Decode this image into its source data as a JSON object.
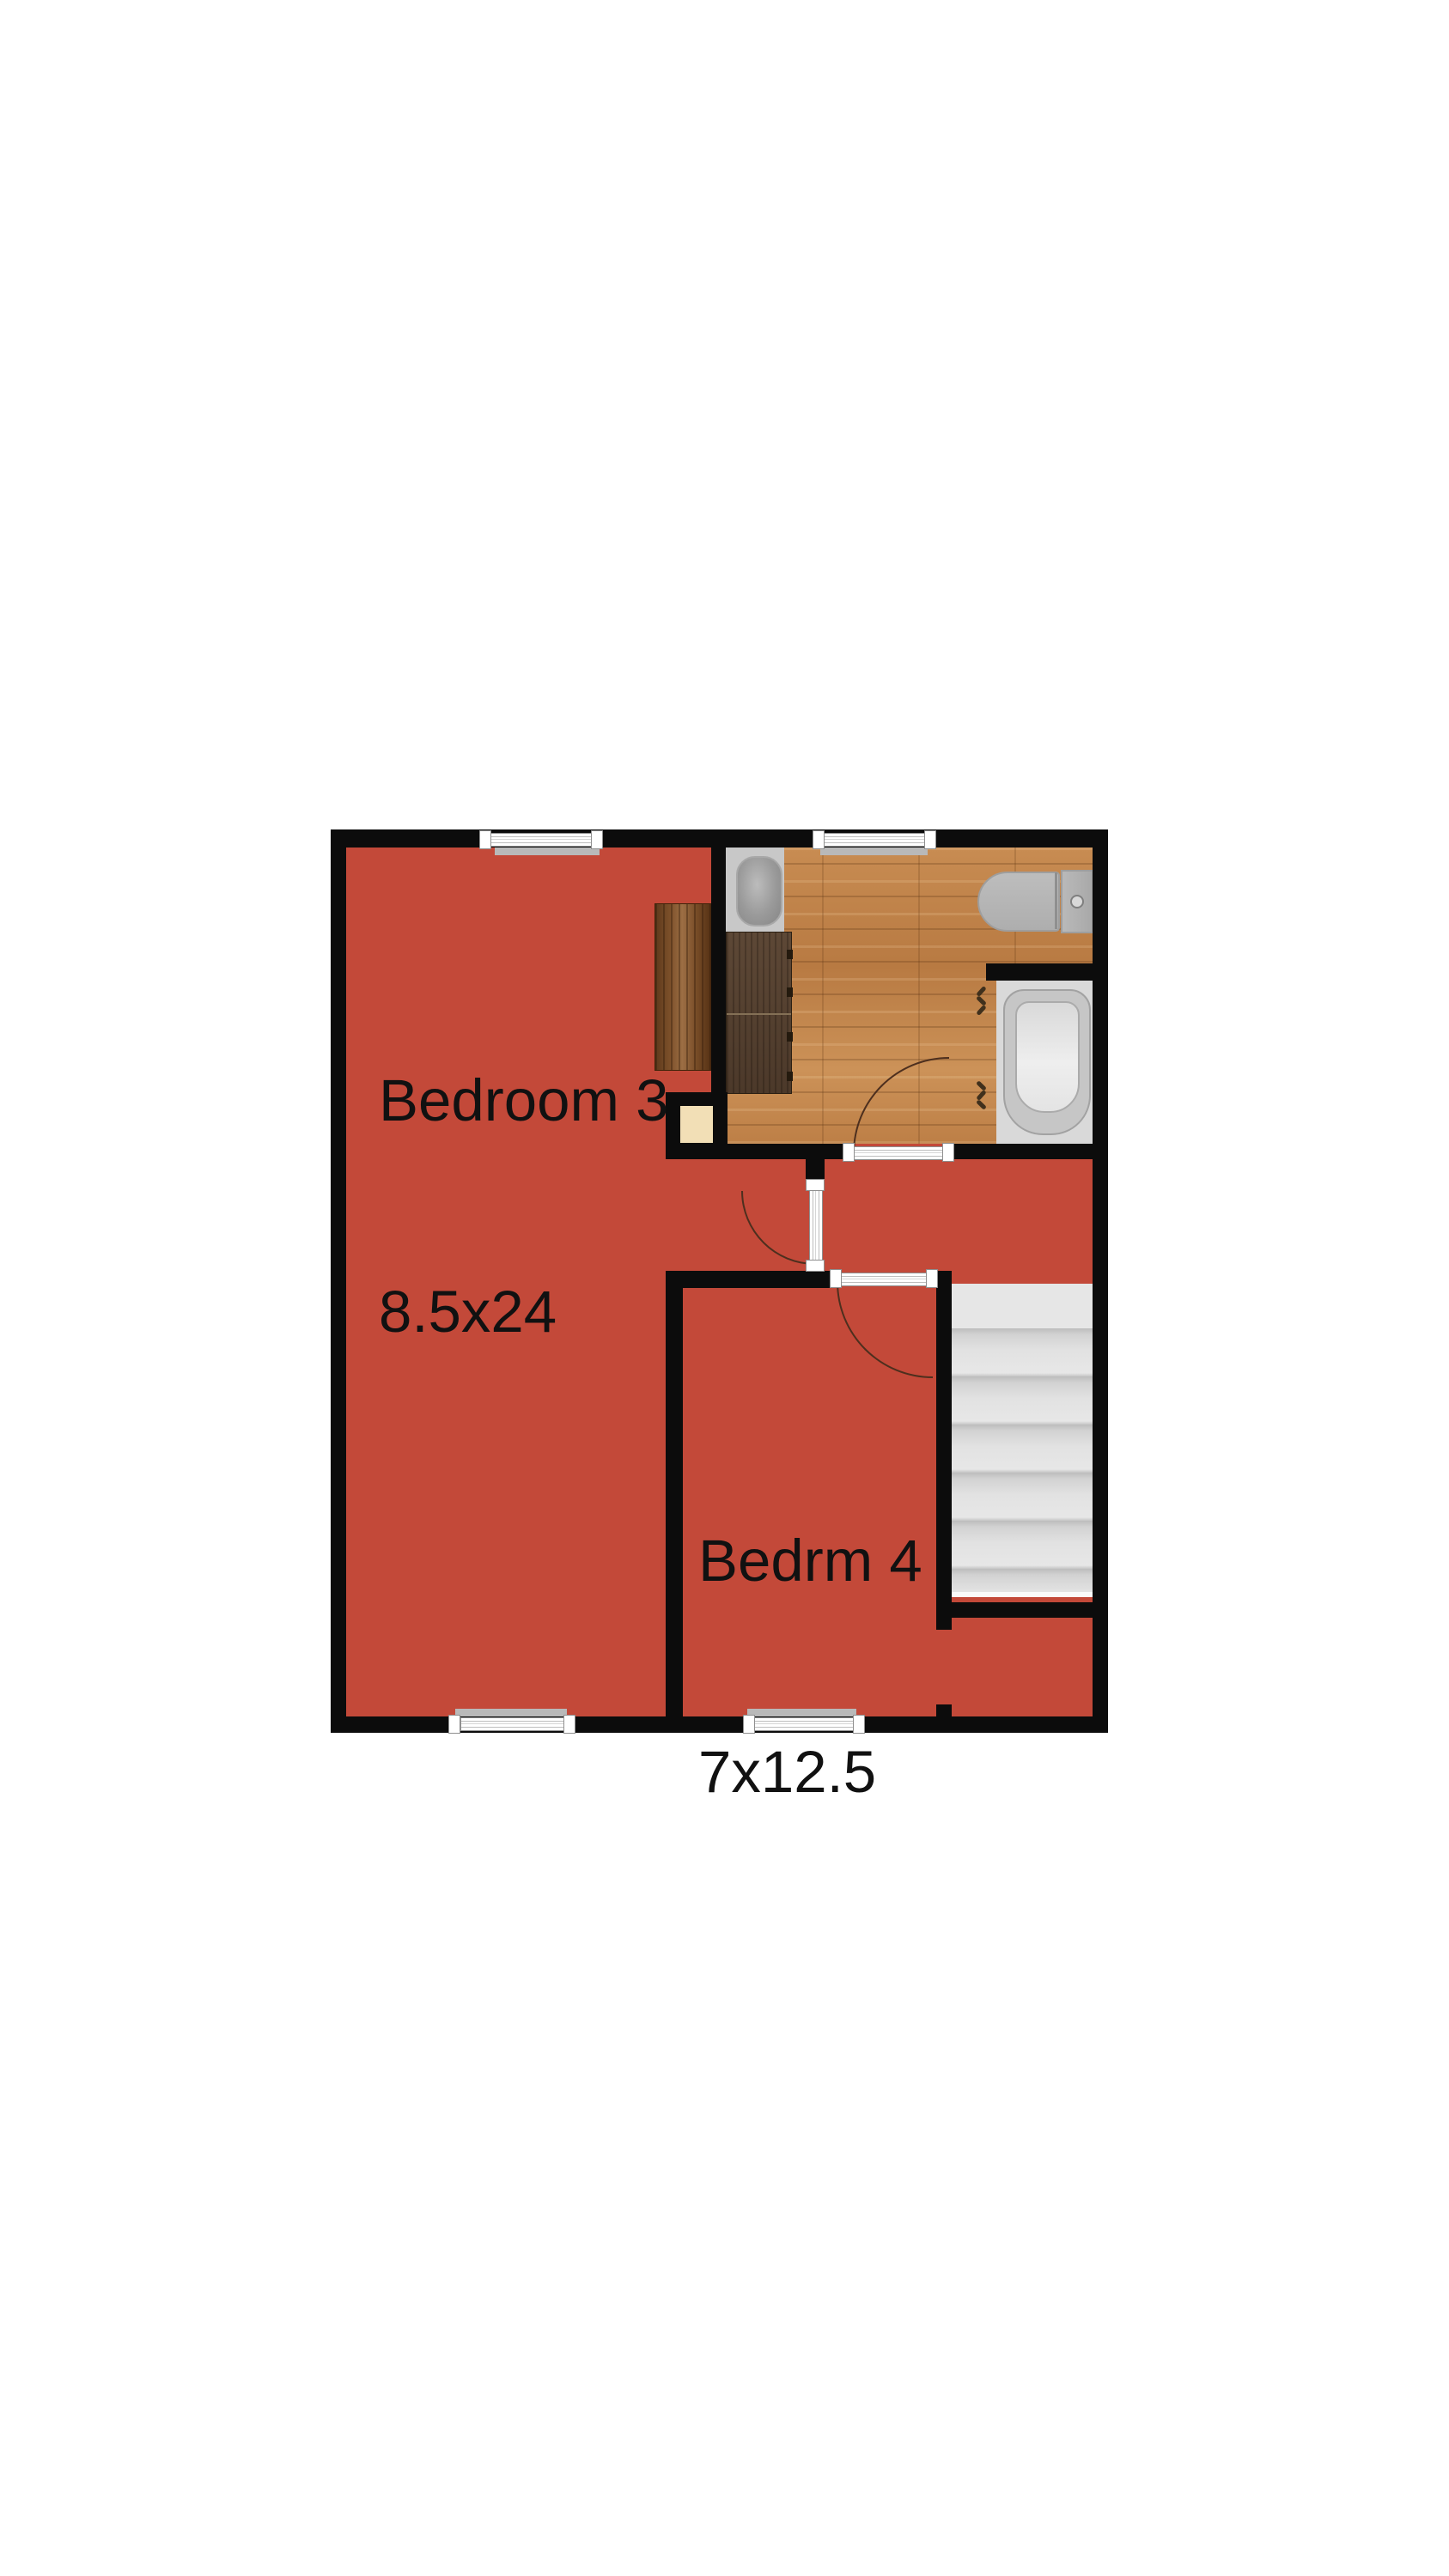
{
  "rooms": [
    {
      "name": "Bedroom 3",
      "dimensions": "8.5x24"
    },
    {
      "name": "Bedrm 4",
      "dimensions": "7x12.5"
    }
  ],
  "fixtures": [
    "bathroom-sink",
    "vanity-cabinet",
    "toilet",
    "bathtub",
    "staircase",
    "desk",
    "closet-niche"
  ],
  "window_count": 4,
  "door_count": 3,
  "colors": {
    "room_fill": "#c34939",
    "wall": "#0c0c0c",
    "bathroom_floor_wood": "#c08248",
    "stairs_gray": "#dedede",
    "fixture_gray": "#b5b5b5",
    "niche_beige": "#f2dfb6",
    "desk_wood": "#6f4526",
    "vanity_wood": "#54402f",
    "door_swing_line": "#4d2f1e",
    "window_frame": "#8f8f8f",
    "background": "#ffffff",
    "label_text": "#111111"
  }
}
